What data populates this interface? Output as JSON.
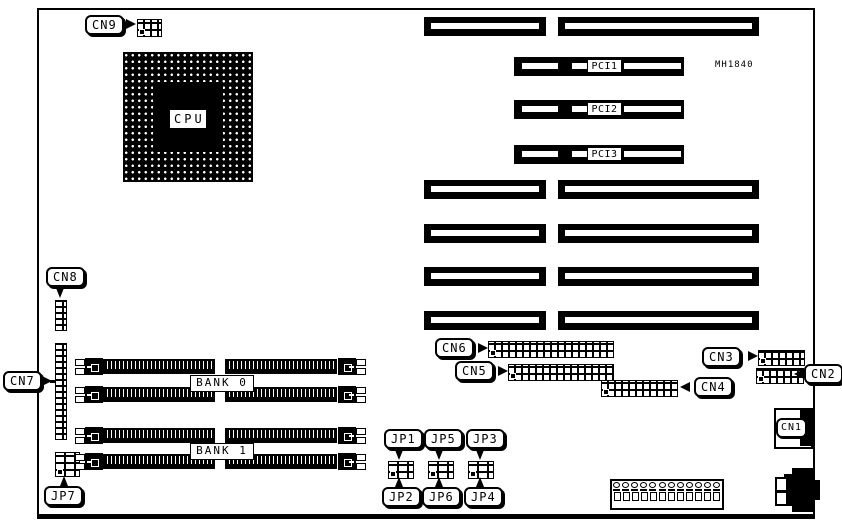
{
  "diagram": {
    "model": "MH1840",
    "cpu_label": "CPU",
    "pci_slots": [
      {
        "label": "PCI1"
      },
      {
        "label": "PCI2"
      },
      {
        "label": "PCI3"
      }
    ],
    "memory_banks": [
      {
        "label": "BANK 0"
      },
      {
        "label": "BANK 1"
      }
    ],
    "connectors": {
      "cn1": "CN1",
      "cn2": "CN2",
      "cn3": "CN3",
      "cn4": "CN4",
      "cn5": "CN5",
      "cn6": "CN6",
      "cn7": "CN7",
      "cn8": "CN8",
      "cn9": "CN9"
    },
    "jumpers": {
      "jp1": "JP1",
      "jp2": "JP2",
      "jp3": "JP3",
      "jp4": "JP4",
      "jp5": "JP5",
      "jp6": "JP6",
      "jp7": "JP7"
    }
  }
}
